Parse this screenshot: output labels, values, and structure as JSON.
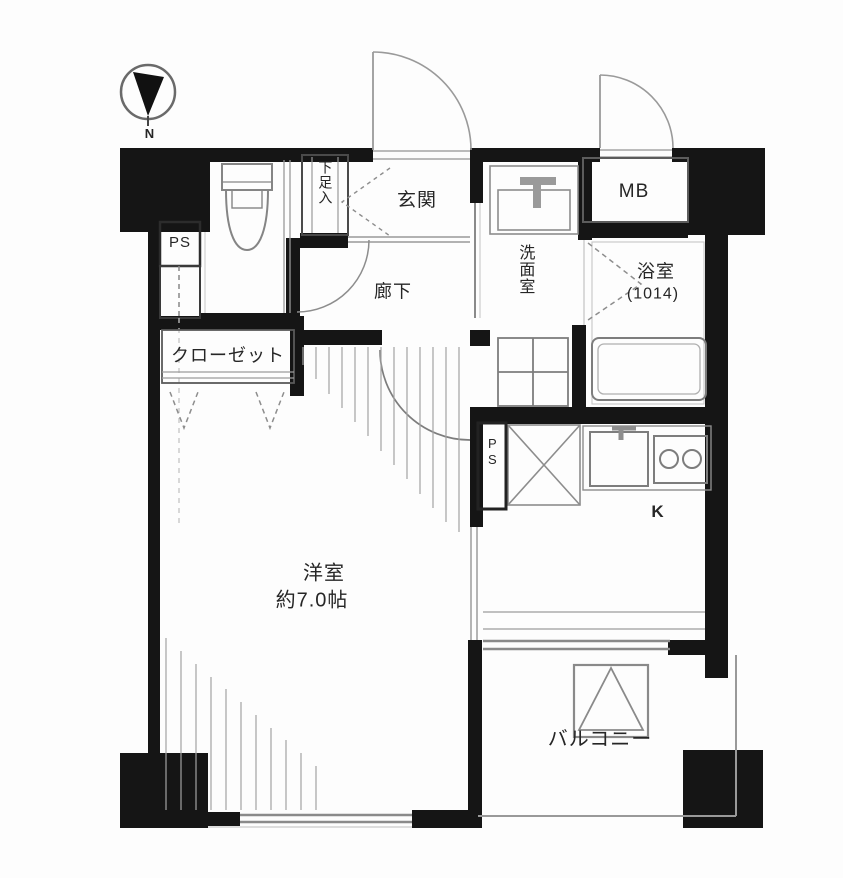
{
  "title": "apartment-floor-plan",
  "compass": {
    "north_label": "N"
  },
  "labels": {
    "pipe_space_upper": "PS",
    "shoe_cabinet": "下足入",
    "entrance": "玄関",
    "meter_box": "MB",
    "washroom": "洗面室",
    "bathroom_name": "浴室",
    "bathroom_size": "(1014)",
    "corridor": "廊下",
    "closet": "クローゼット",
    "western_room_name": "洋室",
    "western_room_size": "約7.0帖",
    "pipe_space_kitchen": "PS",
    "kitchen": "K",
    "balcony": "バルコニー"
  },
  "colors": {
    "wall": "#151515",
    "thin_line": "#8f8f8f",
    "fixture_line": "#7d7d7d",
    "text": "#262626"
  }
}
